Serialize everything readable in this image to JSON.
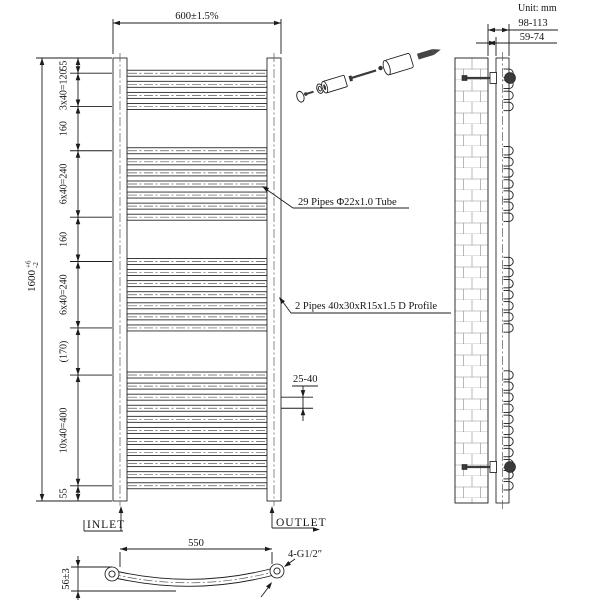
{
  "unit_label": "Unit: mm",
  "front_view": {
    "width_dim": "600±1.5%",
    "height_dim": "1600",
    "height_tol_plus": "+6",
    "height_tol_minus": "-2",
    "dim_chain": [
      "55",
      "3x40=120",
      "160",
      "6x40=240",
      "160",
      "6x40=240",
      "(170)",
      "10x40=400",
      "55"
    ],
    "dim_chain_boundaries_mm": [
      0,
      55,
      175,
      335,
      575,
      735,
      975,
      1145,
      1545,
      1600
    ],
    "pipe_pitch_mm": 40,
    "pipe_od_mm": 22,
    "pipe_groups": [
      {
        "start_mm": 55,
        "count": 4
      },
      {
        "start_mm": 335,
        "count": 7
      },
      {
        "start_mm": 735,
        "count": 7
      },
      {
        "start_mm": 1145,
        "count": 11
      }
    ],
    "total_pipes": 29,
    "pipe_note": "29 Pipes Φ22x1.0 Tube",
    "profile_note": "2 Pipes 40x30xR15x1.5 D Profile",
    "gap_dim": "25-40",
    "inlet_label": "INLET",
    "outlet_label": "OUTLET"
  },
  "side_view": {
    "depth_dim": "98-113",
    "gap_dim": "59-74"
  },
  "bottom_view": {
    "width_dim": "550",
    "depth_dim": "56±3",
    "thread_label": "4-G1/2″"
  }
}
